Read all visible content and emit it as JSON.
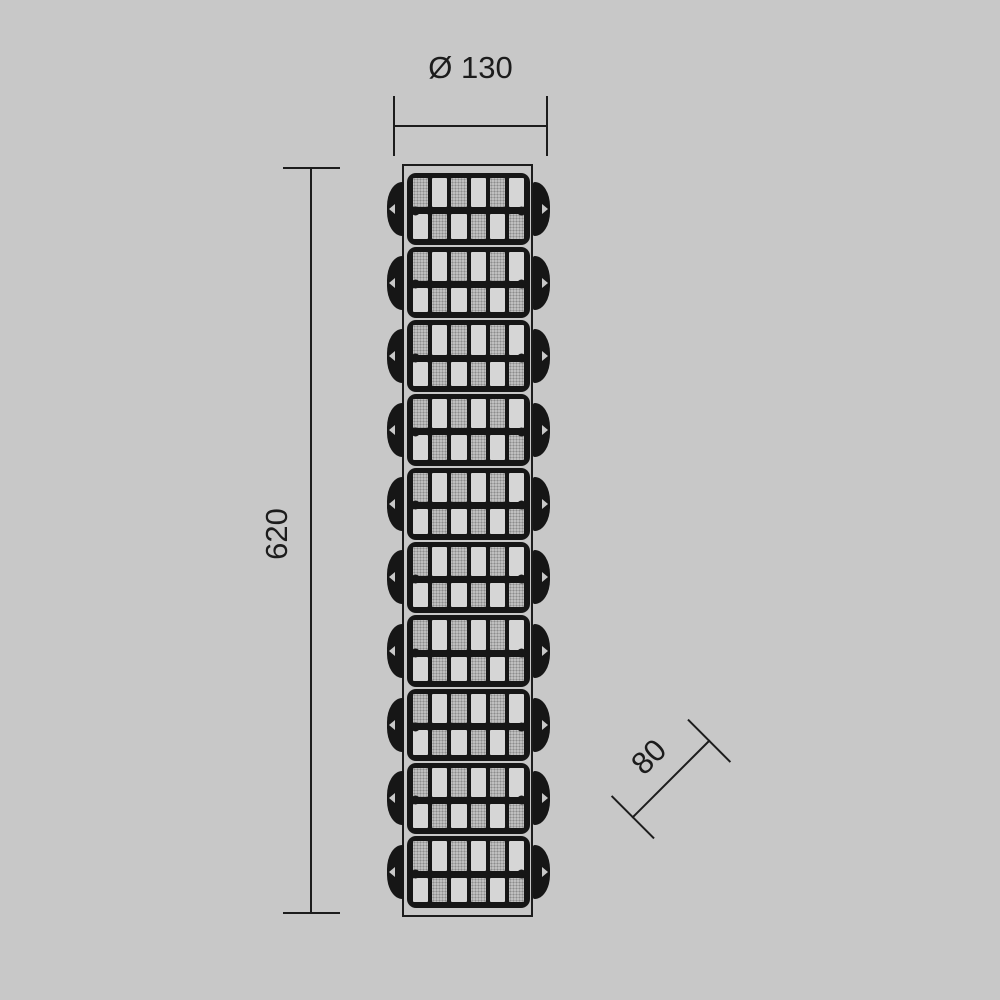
{
  "drawing": {
    "type": "technical-dimension-drawing",
    "dimensions": {
      "diameter_label": "Ø 130",
      "height_label": "620",
      "depth_label": "80"
    },
    "fixture": {
      "segment_count": 10,
      "grid_columns": 6,
      "grid_rows": 2
    }
  },
  "colors": {
    "background": "#c8c8c8",
    "line": "#1c1c1c",
    "frame": "#161616",
    "cell_plain": "#d6d6d6",
    "cell_stipple": "#bfbfbf",
    "stipple_dot": "#8c8c8c"
  }
}
